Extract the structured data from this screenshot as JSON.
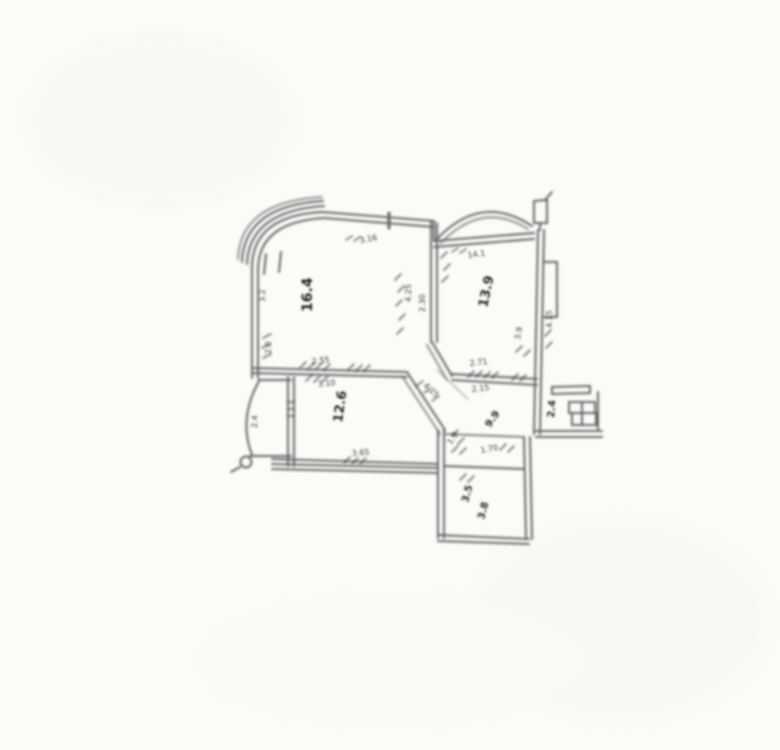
{
  "document": {
    "description": "Blurry scanned architectural floor plan of an apartment, centered on white paper",
    "colors": {
      "paper": "#fbfbf8",
      "ink": "#4a4a4a",
      "ink_dark": "#2a2a2a"
    }
  },
  "annotations": [
    {
      "id": "room-main-area",
      "text": "16.4"
    },
    {
      "id": "room-right-area",
      "text": "13.9"
    },
    {
      "id": "room-lower-left-area",
      "text": "12.6"
    },
    {
      "id": "hall-area",
      "text": "9.9"
    },
    {
      "id": "bath-area-a",
      "text": "3.5"
    },
    {
      "id": "bath-area-b",
      "text": "3.8"
    },
    {
      "id": "porch-area",
      "text": "2.4"
    },
    {
      "id": "bay-area",
      "text": "2.4"
    },
    {
      "id": "dim-top",
      "text": "3.16"
    },
    {
      "id": "dim-arch",
      "text": "14.1"
    },
    {
      "id": "dim-a",
      "text": "2.55"
    },
    {
      "id": "dim-b",
      "text": "3.10"
    },
    {
      "id": "dim-c",
      "text": "3.65"
    },
    {
      "id": "dim-d",
      "text": "4.25"
    },
    {
      "id": "dim-e",
      "text": "2.30"
    },
    {
      "id": "dim-f",
      "text": "2.71"
    },
    {
      "id": "dim-g",
      "text": "2.15"
    },
    {
      "id": "dim-h",
      "text": "4.25"
    },
    {
      "id": "dim-i",
      "text": "4.15"
    },
    {
      "id": "dim-j",
      "text": "2.0"
    },
    {
      "id": "dim-k",
      "text": "3.2"
    },
    {
      "id": "dim-l",
      "text": "3.9"
    },
    {
      "id": "dim-m",
      "text": "1.70"
    },
    {
      "id": "dim-n",
      "text": "1.9"
    }
  ]
}
